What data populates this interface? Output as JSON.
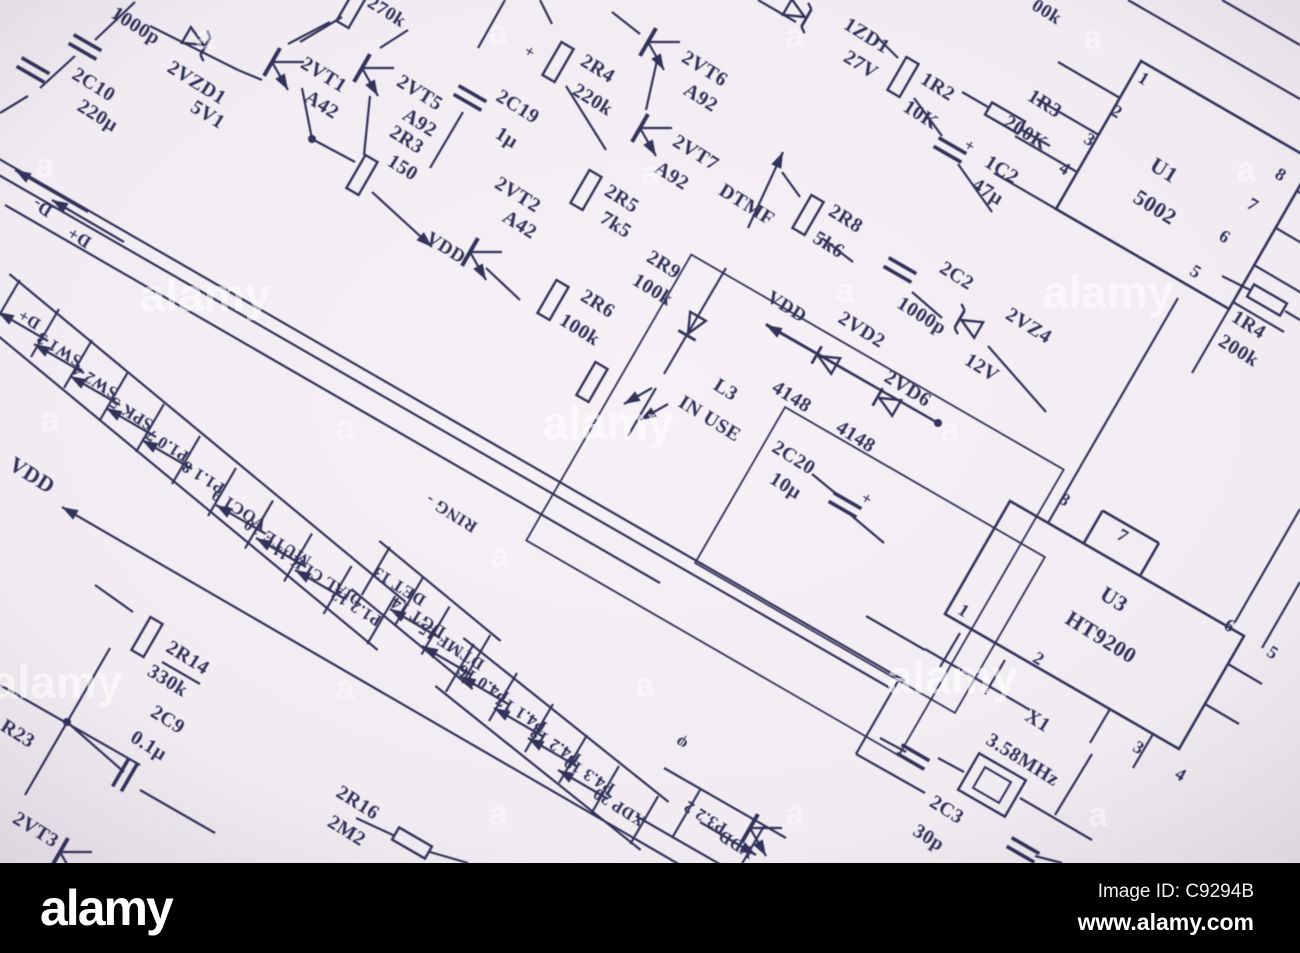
{
  "footer": {
    "logo": "alamy",
    "image_id": "Image ID: C9294B",
    "url": "www.alamy.com"
  },
  "colors": {
    "paper": "#f1ecf2",
    "paper_edge": "#ddd5de",
    "ink": "#32325a",
    "bar": "#000000",
    "watermark": "#ffffff"
  },
  "schematic": {
    "labels": [
      {
        "t": "1000p",
        "x": 135,
        "y": 27,
        "s": 20
      },
      {
        "t": "2VZD1",
        "x": 196,
        "y": 84,
        "s": 20
      },
      {
        "t": "5V1",
        "x": 207,
        "y": 116,
        "s": 20
      },
      {
        "t": "2C10",
        "x": 93,
        "y": 86,
        "s": 20
      },
      {
        "t": "220µ",
        "x": 97,
        "y": 117,
        "s": 20
      },
      {
        "t": "2VT1",
        "x": 323,
        "y": 76,
        "s": 20
      },
      {
        "t": "A42",
        "x": 321,
        "y": 106,
        "s": 20
      },
      {
        "t": "2VT5",
        "x": 419,
        "y": 94,
        "s": 20
      },
      {
        "t": "A92",
        "x": 419,
        "y": 124,
        "s": 20
      },
      {
        "t": "270k",
        "x": 386,
        "y": 13,
        "s": 19
      },
      {
        "t": "2R3",
        "x": 406,
        "y": 141,
        "s": 20
      },
      {
        "t": "150",
        "x": 402,
        "y": 169,
        "s": 20
      },
      {
        "t": "2C19",
        "x": 517,
        "y": 108,
        "s": 20
      },
      {
        "t": "1µ",
        "x": 506,
        "y": 139,
        "s": 20
      },
      {
        "t": "+",
        "x": 529,
        "y": 53,
        "s": 17
      },
      {
        "t": "2R4",
        "x": 597,
        "y": 70,
        "s": 20
      },
      {
        "t": "220k",
        "x": 592,
        "y": 101,
        "s": 20
      },
      {
        "t": "2VT6",
        "x": 704,
        "y": 70,
        "s": 20
      },
      {
        "t": "A92",
        "x": 700,
        "y": 99,
        "s": 20
      },
      {
        "t": "2VT7",
        "x": 695,
        "y": 154,
        "s": 20
      },
      {
        "t": "A92",
        "x": 671,
        "y": 177,
        "s": 20
      },
      {
        "t": "DTMF",
        "x": 746,
        "y": 206,
        "s": 20
      },
      {
        "t": "2VT2",
        "x": 517,
        "y": 196,
        "s": 20
      },
      {
        "t": "A42",
        "x": 519,
        "y": 226,
        "s": 20
      },
      {
        "t": "2R5",
        "x": 621,
        "y": 200,
        "s": 20
      },
      {
        "t": "7k5",
        "x": 615,
        "y": 226,
        "s": 20
      },
      {
        "t": "2R9",
        "x": 663,
        "y": 266,
        "s": 20
      },
      {
        "t": "100k",
        "x": 652,
        "y": 291,
        "s": 20
      },
      {
        "t": "VDD",
        "x": 445,
        "y": 249,
        "s": 19
      },
      {
        "t": "2R6",
        "x": 597,
        "y": 305,
        "s": 20
      },
      {
        "t": "100k",
        "x": 579,
        "y": 331,
        "s": 20
      },
      {
        "t": "2R8",
        "x": 845,
        "y": 220,
        "s": 20
      },
      {
        "t": "5k6",
        "x": 828,
        "y": 246,
        "s": 20
      },
      {
        "t": "2C2",
        "x": 956,
        "y": 277,
        "s": 20
      },
      {
        "t": "1000p",
        "x": 921,
        "y": 317,
        "s": 20
      },
      {
        "t": "2VZ4",
        "x": 1028,
        "y": 327,
        "s": 20
      },
      {
        "t": "12V",
        "x": 981,
        "y": 369,
        "s": 20
      },
      {
        "t": "1ZD1",
        "x": 866,
        "y": 37,
        "s": 20
      },
      {
        "t": "27V",
        "x": 860,
        "y": 66,
        "s": 20
      },
      {
        "t": "1R2",
        "x": 937,
        "y": 88,
        "s": 20
      },
      {
        "t": "10K",
        "x": 920,
        "y": 116,
        "s": 20
      },
      {
        "t": "1R3",
        "x": 1044,
        "y": 105,
        "s": 20
      },
      {
        "t": "200K",
        "x": 1025,
        "y": 134,
        "s": 20
      },
      {
        "t": "1C2",
        "x": 1001,
        "y": 171,
        "s": 20
      },
      {
        "t": "47µ",
        "x": 987,
        "y": 193,
        "s": 20
      },
      {
        "t": "+",
        "x": 969,
        "y": 147,
        "s": 17
      },
      {
        "t": "U1",
        "x": 1163,
        "y": 172,
        "s": 22
      },
      {
        "t": "5002",
        "x": 1154,
        "y": 209,
        "s": 22
      },
      {
        "t": "00k",
        "x": 1046,
        "y": 13,
        "s": 19
      },
      {
        "t": "1R4",
        "x": 1248,
        "y": 326,
        "s": 20
      },
      {
        "t": "200k",
        "x": 1238,
        "y": 352,
        "s": 20
      },
      {
        "t": "L3",
        "x": 725,
        "y": 391,
        "s": 20
      },
      {
        "t": "IN USE",
        "x": 709,
        "y": 420,
        "s": 20
      },
      {
        "t": "VDD",
        "x": 786,
        "y": 308,
        "s": 19
      },
      {
        "t": "2VD2",
        "x": 861,
        "y": 331,
        "s": 20
      },
      {
        "t": "2VD6",
        "x": 907,
        "y": 390,
        "s": 20
      },
      {
        "t": "4148",
        "x": 791,
        "y": 398,
        "s": 20
      },
      {
        "t": "4148",
        "x": 855,
        "y": 438,
        "s": 20
      },
      {
        "t": "2C20",
        "x": 793,
        "y": 459,
        "s": 20
      },
      {
        "t": "10µ",
        "x": 785,
        "y": 487,
        "s": 20
      },
      {
        "t": "+",
        "x": 866,
        "y": 500,
        "s": 17
      },
      {
        "t": "X1",
        "x": 1037,
        "y": 722,
        "s": 20
      },
      {
        "t": "3.58MHz",
        "x": 1022,
        "y": 761,
        "s": 20
      },
      {
        "t": "2C3",
        "x": 946,
        "y": 811,
        "s": 20
      },
      {
        "t": "30p",
        "x": 928,
        "y": 839,
        "s": 20
      },
      {
        "t": "2R14",
        "x": 187,
        "y": 659,
        "s": 20
      },
      {
        "t": "330k",
        "x": 167,
        "y": 682,
        "s": 20
      },
      {
        "t": "2C9",
        "x": 167,
        "y": 721,
        "s": 20
      },
      {
        "t": "0.1µ",
        "x": 148,
        "y": 747,
        "s": 20
      },
      {
        "t": "R23",
        "x": 17,
        "y": 735,
        "s": 20
      },
      {
        "t": "2VT3",
        "x": 35,
        "y": 831,
        "s": 20
      },
      {
        "t": "2R16",
        "x": 357,
        "y": 804,
        "s": 20
      },
      {
        "t": "2M2",
        "x": 346,
        "y": 832,
        "s": 20
      },
      {
        "t": "U3",
        "x": 1113,
        "y": 601,
        "s": 22
      },
      {
        "t": "HT9200",
        "x": 1100,
        "y": 639,
        "s": 22
      },
      {
        "t": "VDD",
        "x": 31,
        "y": 477,
        "s": 22
      },
      {
        "t": "1",
        "x": 1143,
        "y": 80,
        "s": 18
      },
      {
        "t": "2",
        "x": 1116,
        "y": 113,
        "s": 18
      },
      {
        "t": "3",
        "x": 1089,
        "y": 141,
        "s": 18
      },
      {
        "t": "4",
        "x": 1064,
        "y": 170,
        "s": 18
      },
      {
        "t": "8",
        "x": 1280,
        "y": 176,
        "s": 18
      },
      {
        "t": "7",
        "x": 1252,
        "y": 206,
        "s": 18
      },
      {
        "t": "6",
        "x": 1224,
        "y": 238,
        "s": 18
      },
      {
        "t": "5",
        "x": 1195,
        "y": 273,
        "s": 18
      },
      {
        "t": "8",
        "x": 1064,
        "y": 501,
        "s": 18
      },
      {
        "t": "7",
        "x": 1122,
        "y": 537,
        "s": 18
      },
      {
        "t": "1",
        "x": 963,
        "y": 612,
        "s": 18
      },
      {
        "t": "2",
        "x": 1038,
        "y": 660,
        "s": 18
      },
      {
        "t": "6",
        "x": 1229,
        "y": 627,
        "s": 18
      },
      {
        "t": "5",
        "x": 1272,
        "y": 654,
        "s": 18
      },
      {
        "t": "3",
        "x": 1138,
        "y": 749,
        "s": 18
      },
      {
        "t": "4",
        "x": 1180,
        "y": 776,
        "s": 18
      },
      {
        "t": "D-",
        "x": 43,
        "y": 206,
        "r": 212,
        "s": 18
      },
      {
        "t": "D+",
        "x": 80,
        "y": 236,
        "r": 212,
        "s": 18
      },
      {
        "t": "D+",
        "x": 30,
        "y": 318,
        "r": 212,
        "s": 17,
        "g": 1
      },
      {
        "t": "SW1 3",
        "x": 60,
        "y": 348,
        "r": 212,
        "s": 17,
        "g": 1,
        "a": 1
      },
      {
        "t": "SW2 4",
        "x": 96,
        "y": 380,
        "r": 212,
        "s": 17,
        "g": 1,
        "a": 1
      },
      {
        "t": "SPK 5",
        "x": 132,
        "y": 412,
        "r": 212,
        "s": 17,
        "g": 1,
        "a": 1
      },
      {
        "t": "P1.0 7",
        "x": 168,
        "y": 444,
        "r": 212,
        "s": 17,
        "g": 1,
        "a": 1
      },
      {
        "t": "P1.1 8",
        "x": 204,
        "y": 476,
        "r": 212,
        "s": 17,
        "g": 1,
        "a": 1
      },
      {
        "t": "VOC1 9",
        "x": 240,
        "y": 508,
        "r": 212,
        "s": 17,
        "g": 1
      },
      {
        "t": "MUTE 10",
        "x": 278,
        "y": 541,
        "r": 212,
        "s": 17,
        "g": 1,
        "a": 1
      },
      {
        "t": "DIAL CLK 11",
        "x": 318,
        "y": 574,
        "r": 212,
        "s": 16,
        "g": 1,
        "a": 1
      },
      {
        "t": "P1.2 12",
        "x": 357,
        "y": 606,
        "r": 212,
        "s": 17,
        "g": 1,
        "a": 1
      },
      {
        "t": "RING -",
        "x": 452,
        "y": 512,
        "r": 212,
        "s": 17
      },
      {
        "t": "DET 13",
        "x": 400,
        "y": 585,
        "r": 212,
        "s": 17,
        "g": 2
      },
      {
        "t": "DGT 14",
        "x": 419,
        "y": 616,
        "r": 212,
        "s": 17,
        "g": 2
      },
      {
        "t": "DTMF 15",
        "x": 452,
        "y": 645,
        "r": 212,
        "s": 17,
        "g": 2,
        "a": 1
      },
      {
        "t": "P4.0 16",
        "x": 484,
        "y": 682,
        "r": 212,
        "s": 17,
        "g": 3,
        "a": 1
      },
      {
        "t": "P4.1 17",
        "x": 522,
        "y": 712,
        "r": 212,
        "s": 17,
        "g": 3,
        "a": 1
      },
      {
        "t": "P4.2 18",
        "x": 556,
        "y": 744,
        "r": 212,
        "s": 17,
        "g": 3,
        "a": 1
      },
      {
        "t": "P4.3 19",
        "x": 590,
        "y": 774,
        "r": 212,
        "s": 17,
        "g": 3,
        "a": 1
      },
      {
        "t": "XDP 20",
        "x": 620,
        "y": 806,
        "r": 212,
        "s": 17,
        "g": 3,
        "a": 1
      },
      {
        "t": "φ",
        "x": 682,
        "y": 742,
        "r": 212,
        "s": 17
      },
      {
        "t": "P3.2 2",
        "x": 706,
        "y": 816,
        "r": 212,
        "s": 17
      },
      {
        "t": "VDD",
        "x": 737,
        "y": 843,
        "r": 212,
        "s": 17
      }
    ],
    "watermarks": {
      "word": "alamy",
      "letter": "a",
      "word_positions": [
        [
          205,
          299
        ],
        [
          608,
          427
        ],
        [
          1108,
          296
        ],
        [
          952,
          681
        ],
        [
          57,
          686
        ]
      ],
      "letter_positions": [
        [
          205,
          40
        ],
        [
          45,
          168
        ],
        [
          498,
          35
        ],
        [
          650,
          175
        ],
        [
          795,
          38
        ],
        [
          1093,
          40
        ],
        [
          1246,
          172
        ],
        [
          845,
          293
        ],
        [
          950,
          432
        ],
        [
          345,
          430
        ],
        [
          500,
          558
        ],
        [
          345,
          690
        ],
        [
          645,
          687
        ],
        [
          498,
          816
        ],
        [
          795,
          816
        ],
        [
          1098,
          817
        ],
        [
          50,
          422
        ]
      ]
    }
  }
}
